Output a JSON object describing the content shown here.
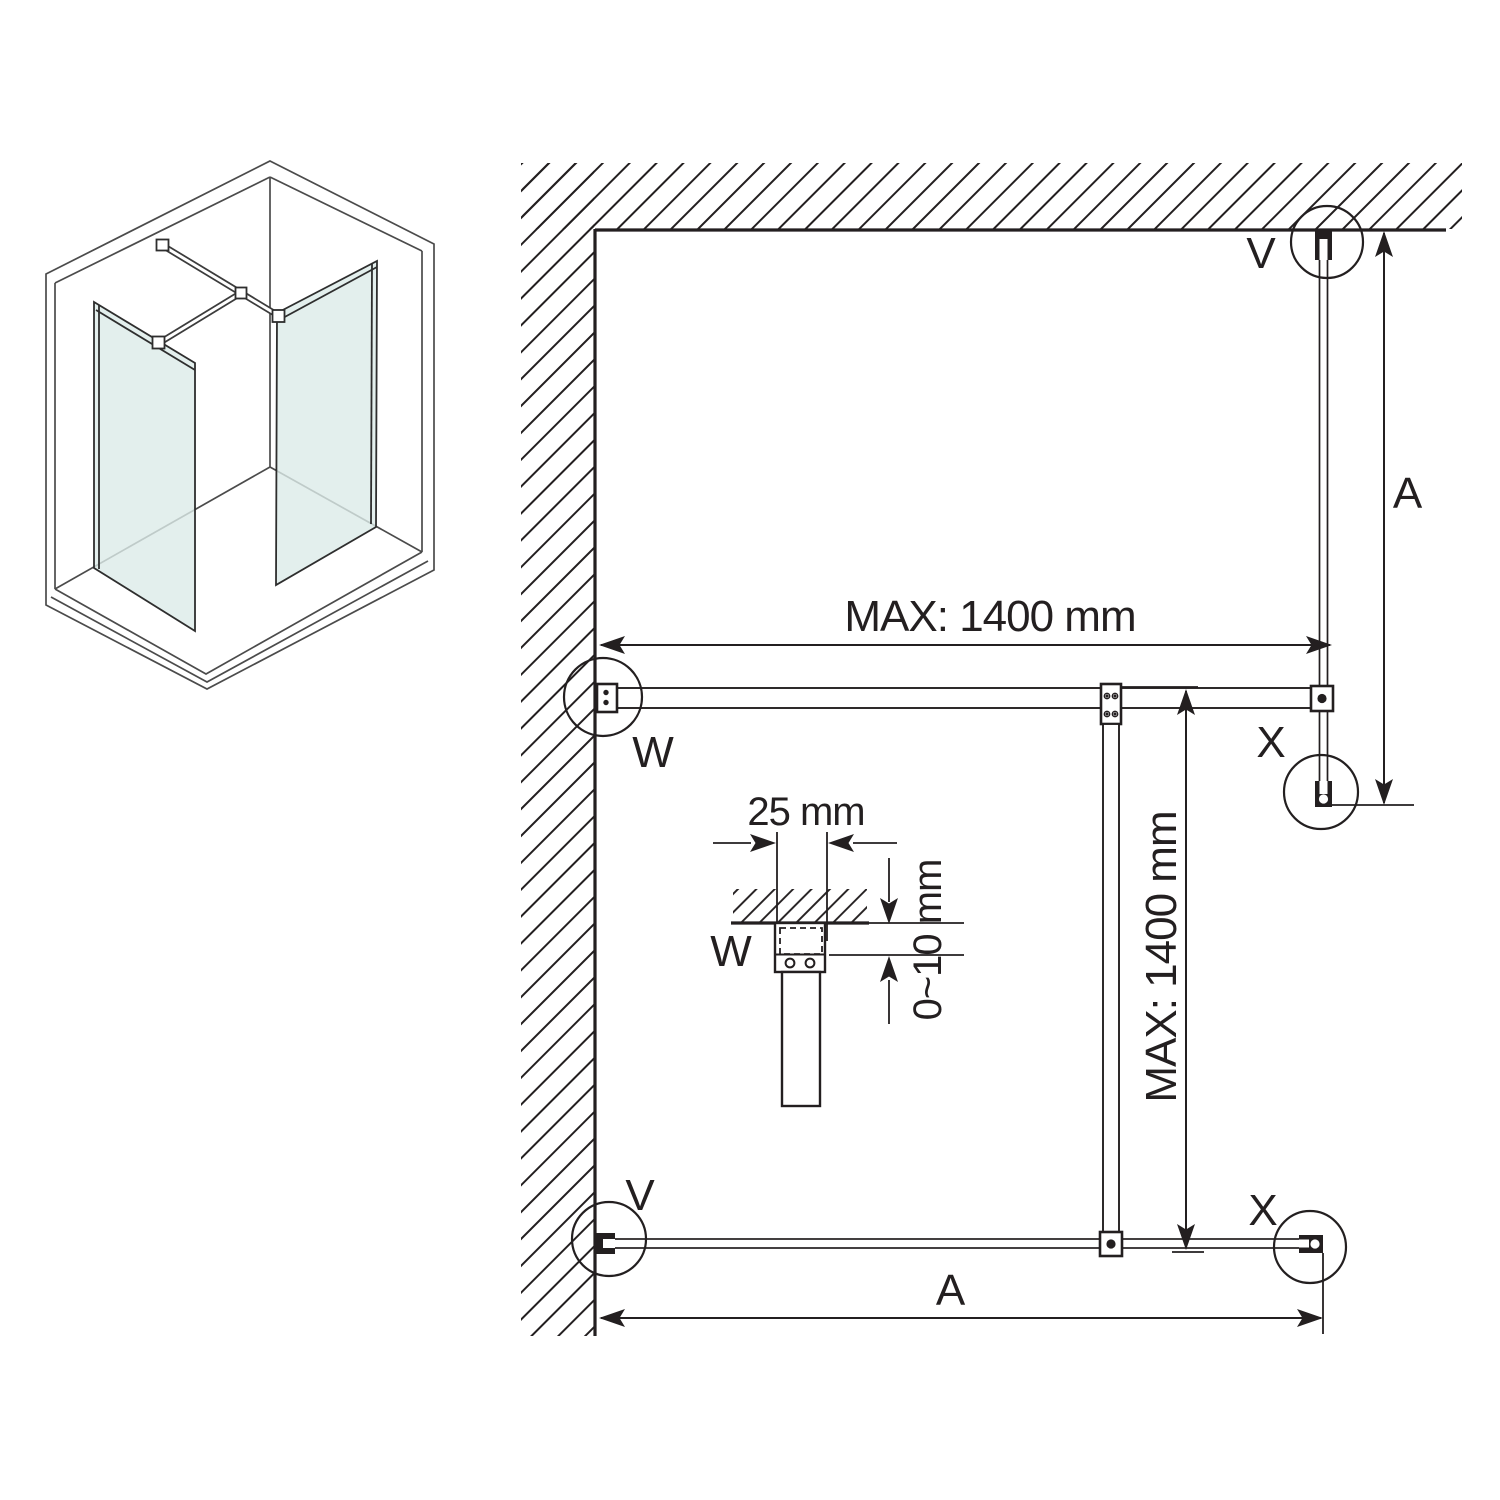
{
  "colors": {
    "line": "#231f20",
    "iso_line": "#4b4b4b",
    "glass": "#dcebe8",
    "background": "#ffffff"
  },
  "plan": {
    "dims": {
      "max_horizontal": "MAX: 1400 mm",
      "max_vertical": "MAX: 1400 mm",
      "a_right": "A",
      "a_bottom": "A"
    },
    "details": {
      "v_top": "V",
      "w_wall": "W",
      "x_right": "X",
      "v_bottom": "V",
      "x_bottom": "X"
    }
  },
  "inset": {
    "label": "W",
    "width": "25 mm",
    "offset": "0~10 mm"
  }
}
